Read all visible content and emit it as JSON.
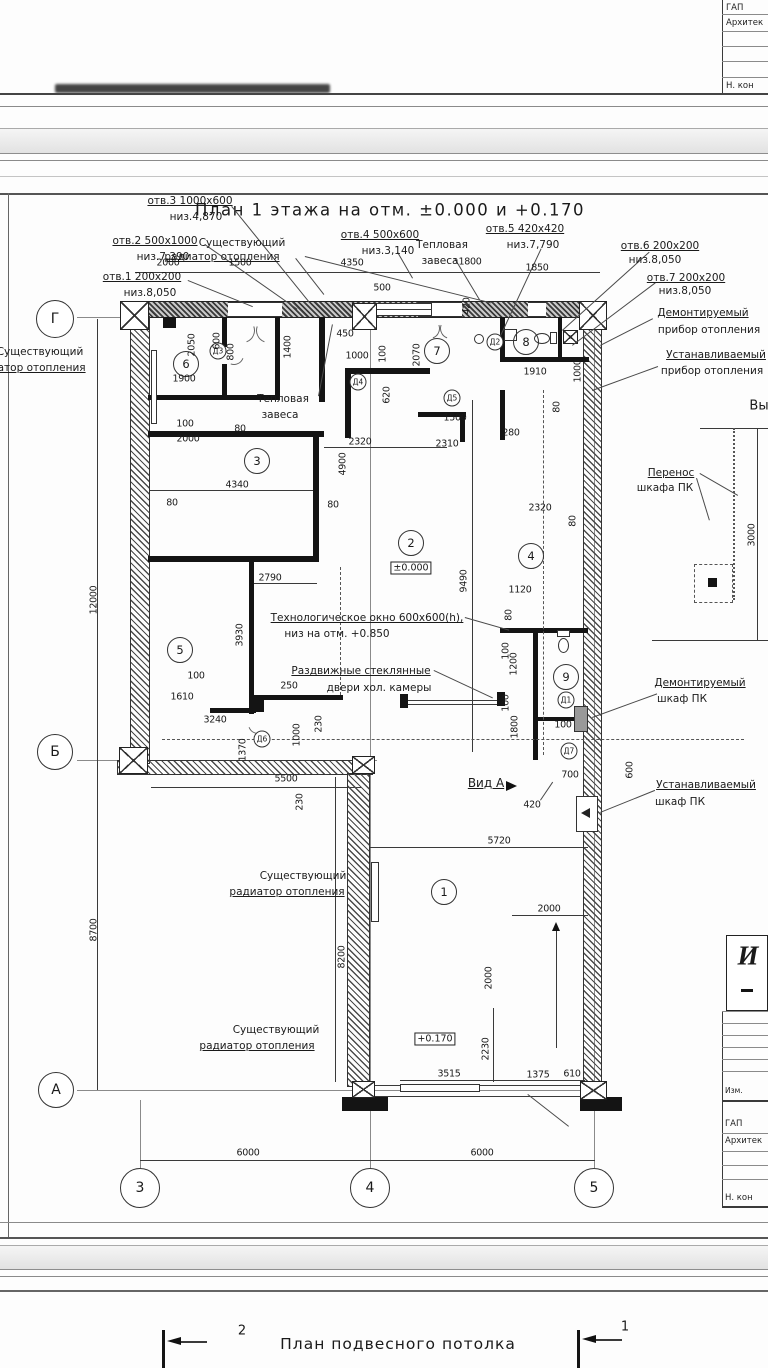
{
  "titles": {
    "main": "План 1 этажа на отм. ±0.000 и +0.170",
    "bottom": "План подвесного потолка"
  },
  "grid": {
    "rows": [
      "Г",
      "Б",
      "А"
    ],
    "cols": [
      "3",
      "4",
      "5"
    ]
  },
  "rooms": [
    "1",
    "2",
    "3",
    "4",
    "5",
    "6",
    "7",
    "8",
    "9"
  ],
  "doors": [
    "Д1",
    "Д2",
    "Д3",
    "Д4",
    "Д5",
    "Д6",
    "Д7"
  ],
  "levels": {
    "zero": "±0.000",
    "one70": "+0.170"
  },
  "openings": [
    {
      "t": "отв.1 200х200",
      "s": "низ.8,050"
    },
    {
      "t": "отв.2 500х1000",
      "s": "низ.7,390"
    },
    {
      "t": "отв.3 1000х600",
      "s": "низ.4,870"
    },
    {
      "t": "отв.4 500х600",
      "s": "низ.3,140"
    },
    {
      "t": "отв.5 420х420",
      "s": "низ.7,790"
    },
    {
      "t": "отв.6 200х200",
      "s": "низ.8,050"
    },
    {
      "t": "отв.7 200х200",
      "s": "низ.8,050"
    }
  ],
  "labels": {
    "rad_top_1": "Существующий",
    "rad_top_2": "радиатор отопления",
    "rad_left_1": "Существующий",
    "rad_left_2": "радиатор отопления",
    "rad_room1_1": "Существующий",
    "rad_room1_2": "радиатор отопления",
    "rad_bottom_1": "Существующий",
    "rad_bottom_2": "радиатор отопления",
    "curtain_top_1": "Тепловая",
    "curtain_top_2": "завеса",
    "curtain_mid_1": "Тепловая",
    "curtain_mid_2": "завеса",
    "demo_heater_1": "Демонтируемый",
    "demo_heater_2": "прибор отопления",
    "install_heater_1": "Устанавливаемый",
    "install_heater_2": "прибор отопления",
    "pk_move_1": "Перенос",
    "pk_move_2": "шкафа ПК",
    "pk_demo_1": "Демонтируемый",
    "pk_demo_2": "шкаф ПК",
    "pk_install_1": "Устанавливаемый",
    "pk_install_2": "шкаф ПК",
    "tech_window_1": "Технологическое окно 600х600(h),",
    "tech_window_2": "низ на отм. +0.850",
    "glass_1": "Раздвижные стеклянные",
    "glass_2": "двери хол. камеры",
    "view_a": "Вид А",
    "partial": "Вы"
  },
  "dims": [
    "2000",
    "1500",
    "4350",
    "500",
    "1800",
    "1850",
    "420",
    "2050",
    "1900",
    "600",
    "800",
    "1400",
    "450",
    "1000",
    "100",
    "2070",
    "620",
    "1910",
    "1000",
    "80",
    "100",
    "2000",
    "80",
    "1500",
    "2310",
    "280",
    "2320",
    "2320",
    "80",
    "4340",
    "80",
    "80",
    "4900",
    "9490",
    "2790",
    "3930",
    "1120",
    "80",
    "100",
    "1610",
    "250",
    "3240",
    "1370",
    "1000",
    "230",
    "5500",
    "230",
    "100",
    "1200",
    "100",
    "1800",
    "100",
    "700",
    "600",
    "420",
    "5720",
    "2000",
    "2000",
    "8200",
    "2230",
    "3515",
    "1375",
    "610",
    "6000",
    "6000",
    "12000",
    "8700",
    "3000"
  ],
  "sections": {
    "left": "2",
    "right": "1"
  },
  "tb": {
    "top": {
      "r1": "ГАП",
      "r2": "Архитек",
      "r3": "Н. кон"
    },
    "bottom": {
      "stamp": "И",
      "izm": "Изм.",
      "r1": "ГАП",
      "r2": "Архитек",
      "r3": "Н. кон"
    }
  }
}
